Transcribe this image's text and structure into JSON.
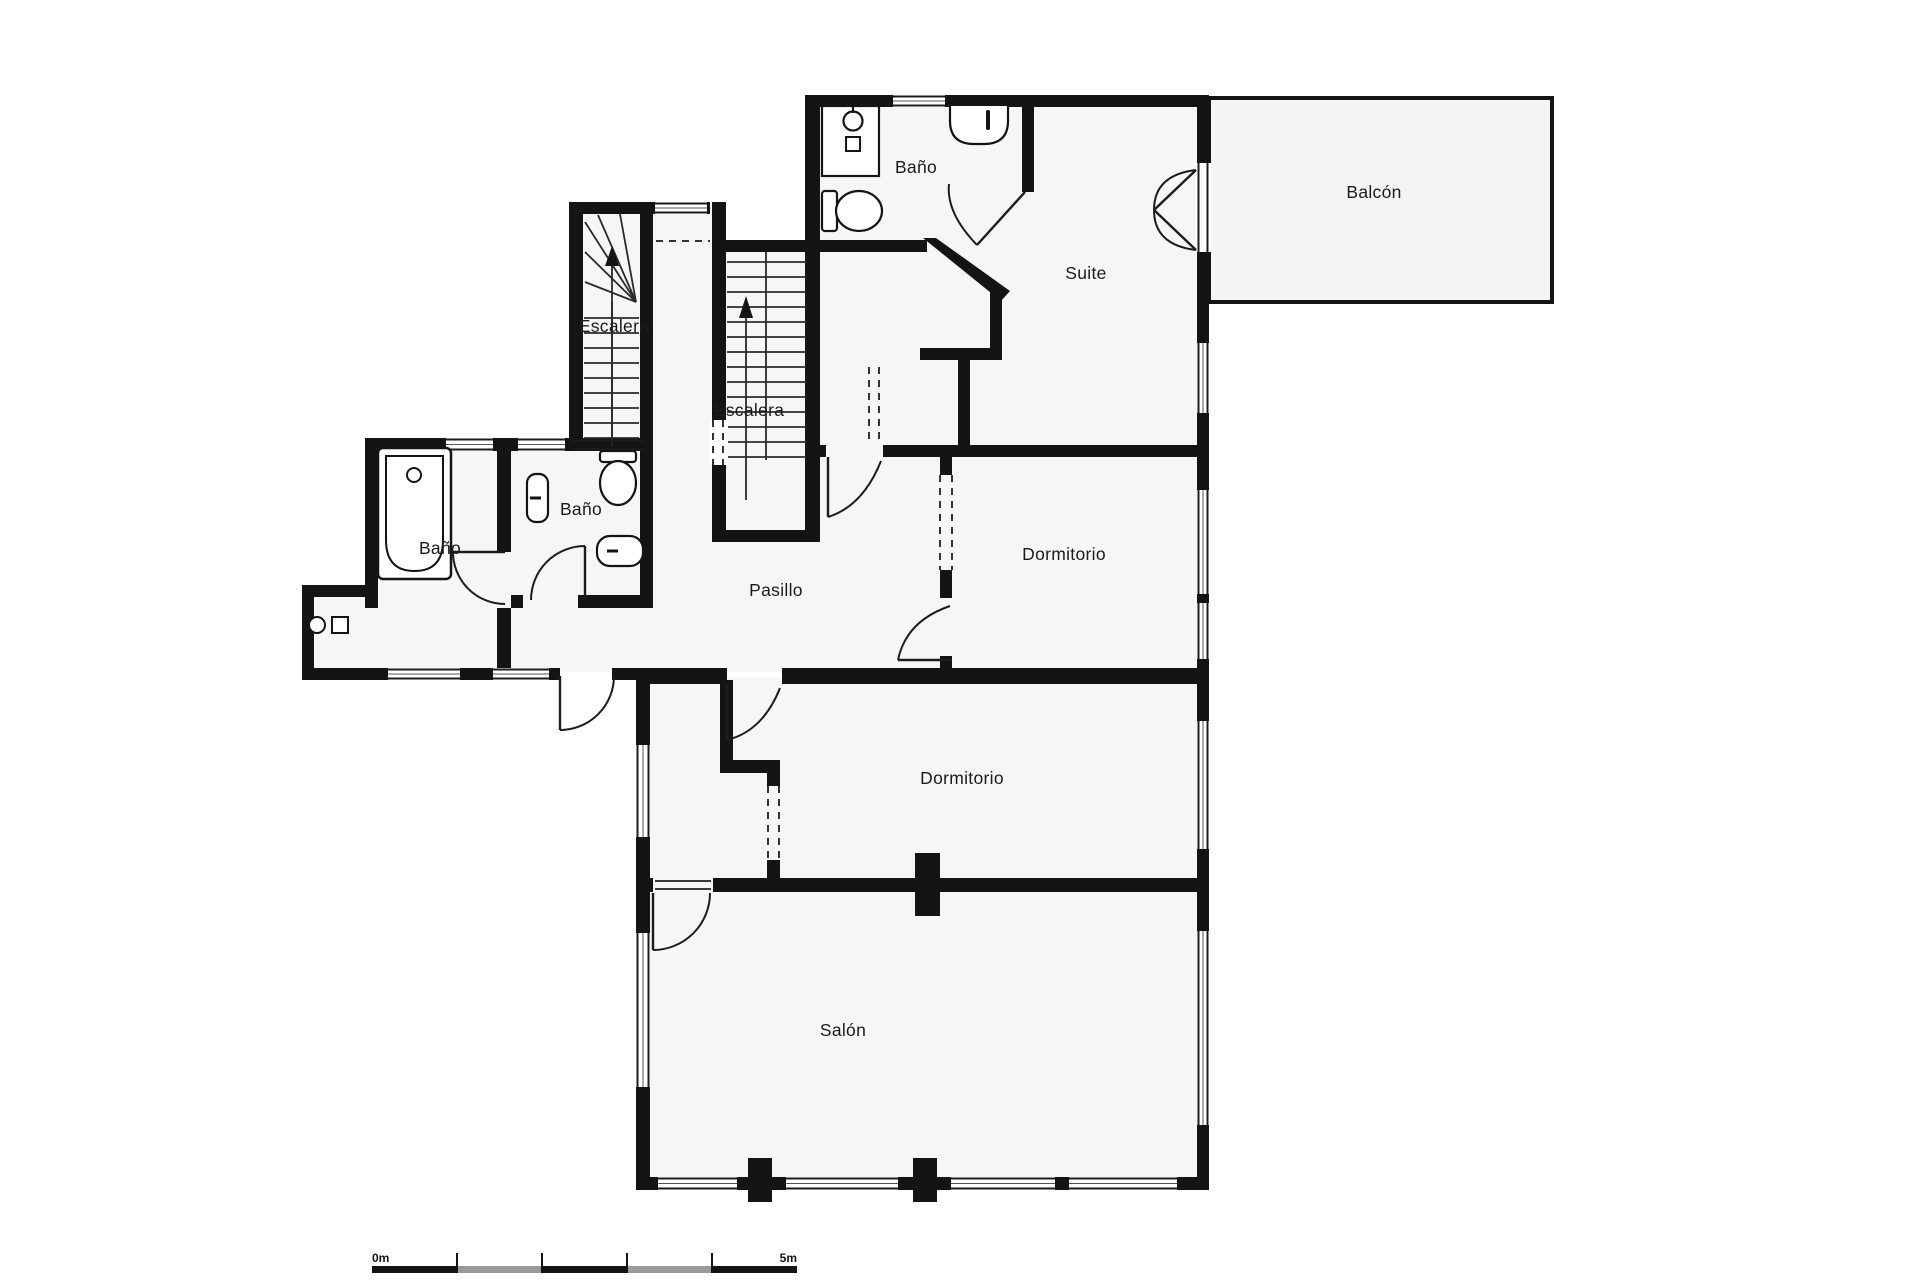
{
  "plan": {
    "title": "Floor plan",
    "rooms": [
      {
        "id": "bano-top",
        "label": "Baño",
        "x": 916,
        "y": 173
      },
      {
        "id": "suite",
        "label": "Suite",
        "x": 1086,
        "y": 279
      },
      {
        "id": "balcon",
        "label": "Balcón",
        "x": 1374,
        "y": 198
      },
      {
        "id": "escalera-a",
        "label": "Escalera",
        "x": 614,
        "y": 332
      },
      {
        "id": "escalera-b",
        "label": "Escalera",
        "x": 749,
        "y": 416
      },
      {
        "id": "bano-middle",
        "label": "Baño",
        "x": 581,
        "y": 515
      },
      {
        "id": "bano-tub",
        "label": "Baño",
        "x": 440,
        "y": 554
      },
      {
        "id": "pasillo",
        "label": "Pasillo",
        "x": 776,
        "y": 596
      },
      {
        "id": "dormitorio-1",
        "label": "Dormitorio",
        "x": 1064,
        "y": 560
      },
      {
        "id": "dormitorio-2",
        "label": "Dormitorio",
        "x": 962,
        "y": 784
      },
      {
        "id": "salon",
        "label": "Salón",
        "x": 843,
        "y": 1036
      }
    ],
    "scale_bar": {
      "zero_label": "0m",
      "five_label": "5m"
    },
    "colors": {
      "wall": "#141414",
      "floor": "#f6f6f5",
      "balcony_floor": "#f4f4f3",
      "line": "#1c1c1c",
      "scale_gray": "#9a9a9a"
    }
  }
}
